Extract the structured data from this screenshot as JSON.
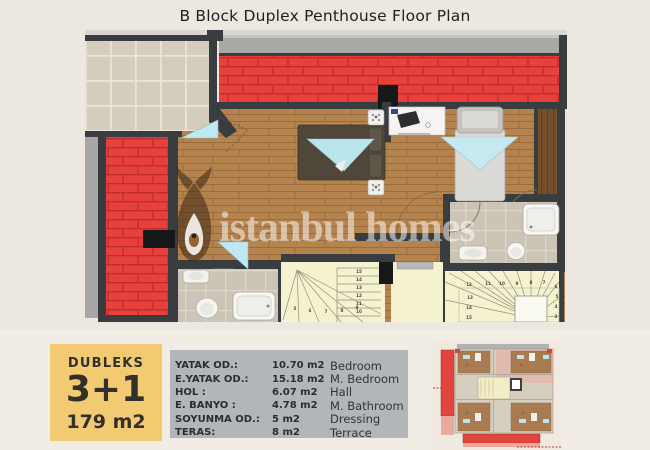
{
  "title": "B Block Duplex Penthouse Floor Plan",
  "watermark": {
    "text": "istanbul homes",
    "logo": "tulip-drop-logo"
  },
  "info_box": {
    "type_label": "DUBLEKS",
    "layout": "3+1",
    "area": "179 m2",
    "bg_color": "#F2CA72"
  },
  "legend": {
    "bg_color": "#B3B6B8",
    "rows": [
      {
        "label": "YATAK OD.:",
        "value": "10.70 m2",
        "name": "Bedroom"
      },
      {
        "label": "E.YATAK OD.:",
        "value": "15.18 m2",
        "name": "M. Bedroom"
      },
      {
        "label": "HOL :",
        "value": "6.07 m2",
        "name": "Hall"
      },
      {
        "label": "E. BANYO :",
        "value": "4.78 m2",
        "name": "M. Bathroom"
      },
      {
        "label": "SOYUNMA OD.:",
        "value": "5 m2",
        "name": "Dressing"
      },
      {
        "label": "TERAS:",
        "value": "8 m2",
        "name": "Terrace"
      }
    ]
  },
  "plan": {
    "stairs": {
      "inner_run": [
        "15",
        "14",
        "13",
        "12",
        "11",
        "10"
      ],
      "inner_winder": [
        "5",
        "6",
        "7",
        "8",
        "9"
      ],
      "outer_top": [
        "12",
        "11",
        "10",
        "9",
        "8",
        "7"
      ],
      "outer_left": [
        "13",
        "14",
        "15"
      ],
      "outer_right": [
        "6",
        "5",
        "4",
        "3"
      ]
    },
    "colors": {
      "wall": "#3A3D40",
      "roof_brick": "#E8403C",
      "wood_floor": "#B5834D",
      "terrace_tile": "#D4CCBC",
      "stair": "#F5F2CF",
      "door_swing": "#BFE9F2",
      "page_bg": "#ECE7DF"
    }
  },
  "thumbnail": {
    "name": "building-overview-plan"
  }
}
